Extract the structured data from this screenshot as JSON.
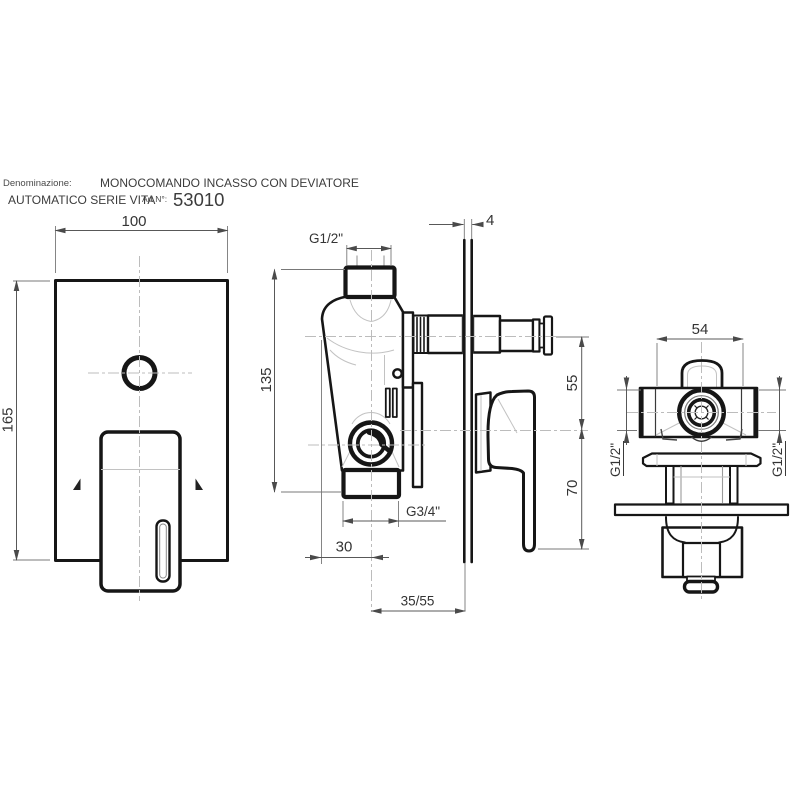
{
  "header": {
    "denominazione_label": "Denominazione:",
    "product_name": "MONOCOMANDO INCASSO CON DEVIATORE",
    "product_name_line2": "AUTOMATICO SERIE VITA",
    "article_label": "Art.N°:",
    "article_number": "53010"
  },
  "front_view": {
    "plate_width": "100",
    "plate_height": "165"
  },
  "side_view": {
    "inlet_thread": "G1/2\"",
    "wall_plate_thickness": "4",
    "body_height": "135",
    "outlet_vertical_offset": "55",
    "handle_drop": "70",
    "outlet_thread": "G3/4\"",
    "outlet_horizontal_offset": "30",
    "installation_depth": "35/55"
  },
  "rear_view": {
    "body_width": "54",
    "left_inlet_thread": "G1/2\"",
    "right_inlet_thread": "G1/2\""
  },
  "colors": {
    "line": "#161616",
    "dimension": "#585858",
    "centerline": "#bcbcbc",
    "text": "#333333",
    "background": "#ffffff"
  }
}
